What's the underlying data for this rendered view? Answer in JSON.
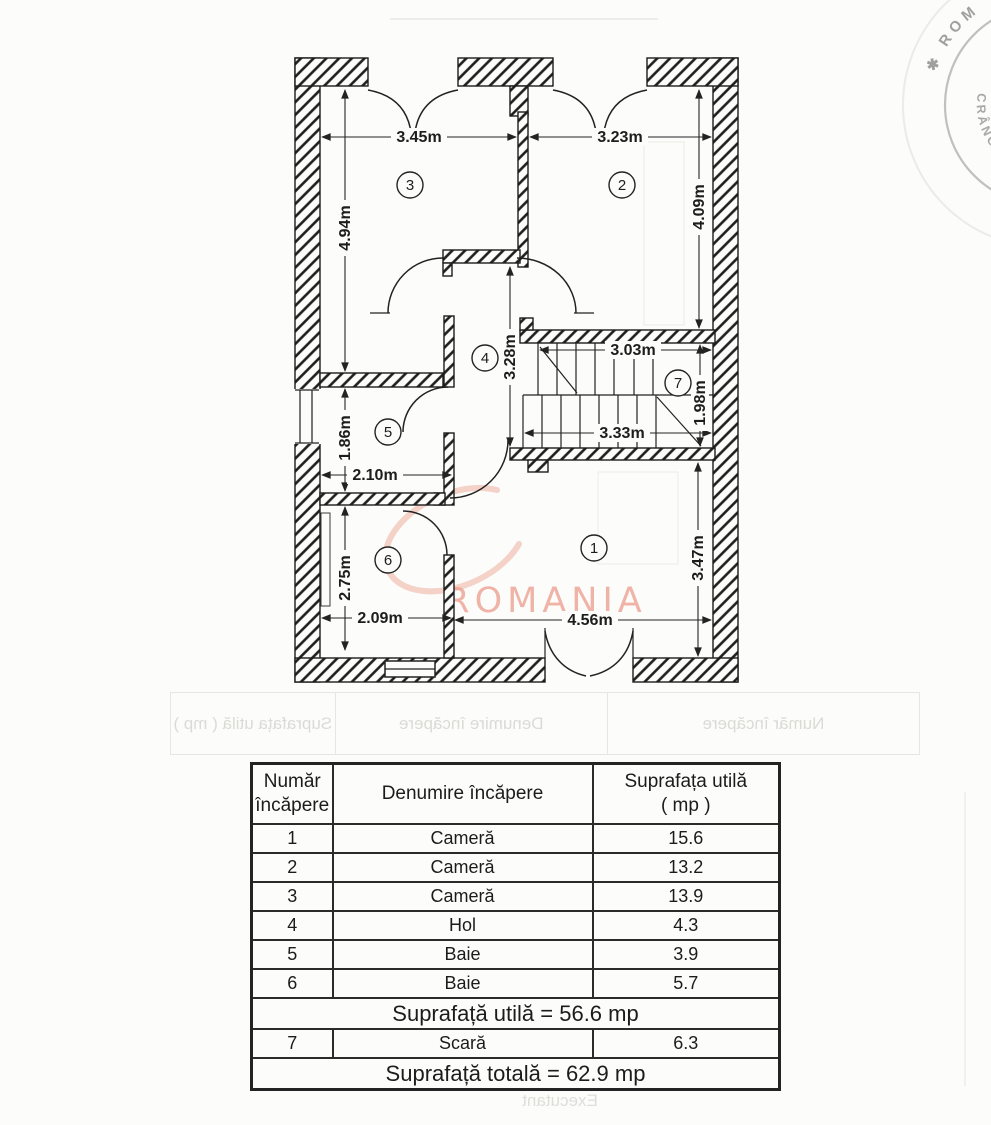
{
  "plan": {
    "room_numbers": [
      "1",
      "2",
      "3",
      "4",
      "5",
      "6",
      "7"
    ],
    "dims": {
      "room3_width": "3.45m",
      "room2_width": "3.23m",
      "room3_height": "4.94m",
      "room2_height": "4.09m",
      "hall_height": "3.28m",
      "stairs_top_width": "3.03m",
      "stairs_bottom_width": "3.33m",
      "stairs_height": "1.98m",
      "baie5_height": "1.86m",
      "baie5_width": "2.10m",
      "baie6_height": "2.75m",
      "baie6_width": "2.09m",
      "room1_width": "4.56m",
      "room1_height": "3.47m"
    },
    "watermark": "ROMANIA"
  },
  "stamp": {
    "outer_text": "✱ ROM",
    "inner_text": "CRÂNGUR"
  },
  "ghost": {
    "header_col_num": "Număr încăpere",
    "header_col_name": "Denumire încăpere",
    "header_col_area": "Suprafața utilă ( mp )",
    "executant": "Executant"
  },
  "table": {
    "header": {
      "col_num_line1": "Număr",
      "col_num_line2": "încăpere",
      "col_name": "Denumire încăpere",
      "col_area_line1": "Suprafața utilă",
      "col_area_line2": "( mp )"
    },
    "rows": [
      {
        "num": "1",
        "name": "Cameră",
        "area": "15.6"
      },
      {
        "num": "2",
        "name": "Cameră",
        "area": "13.2"
      },
      {
        "num": "3",
        "name": "Cameră",
        "area": "13.9"
      },
      {
        "num": "4",
        "name": "Hol",
        "area": "4.3"
      },
      {
        "num": "5",
        "name": "Baie",
        "area": "3.9"
      },
      {
        "num": "6",
        "name": "Baie",
        "area": "5.7"
      }
    ],
    "subtotal": "Suprafață utilă = 56.6 mp",
    "stair_row": {
      "num": "7",
      "name": "Scară",
      "area": "6.3"
    },
    "total": "Suprafață totală = 62.9 mp"
  }
}
